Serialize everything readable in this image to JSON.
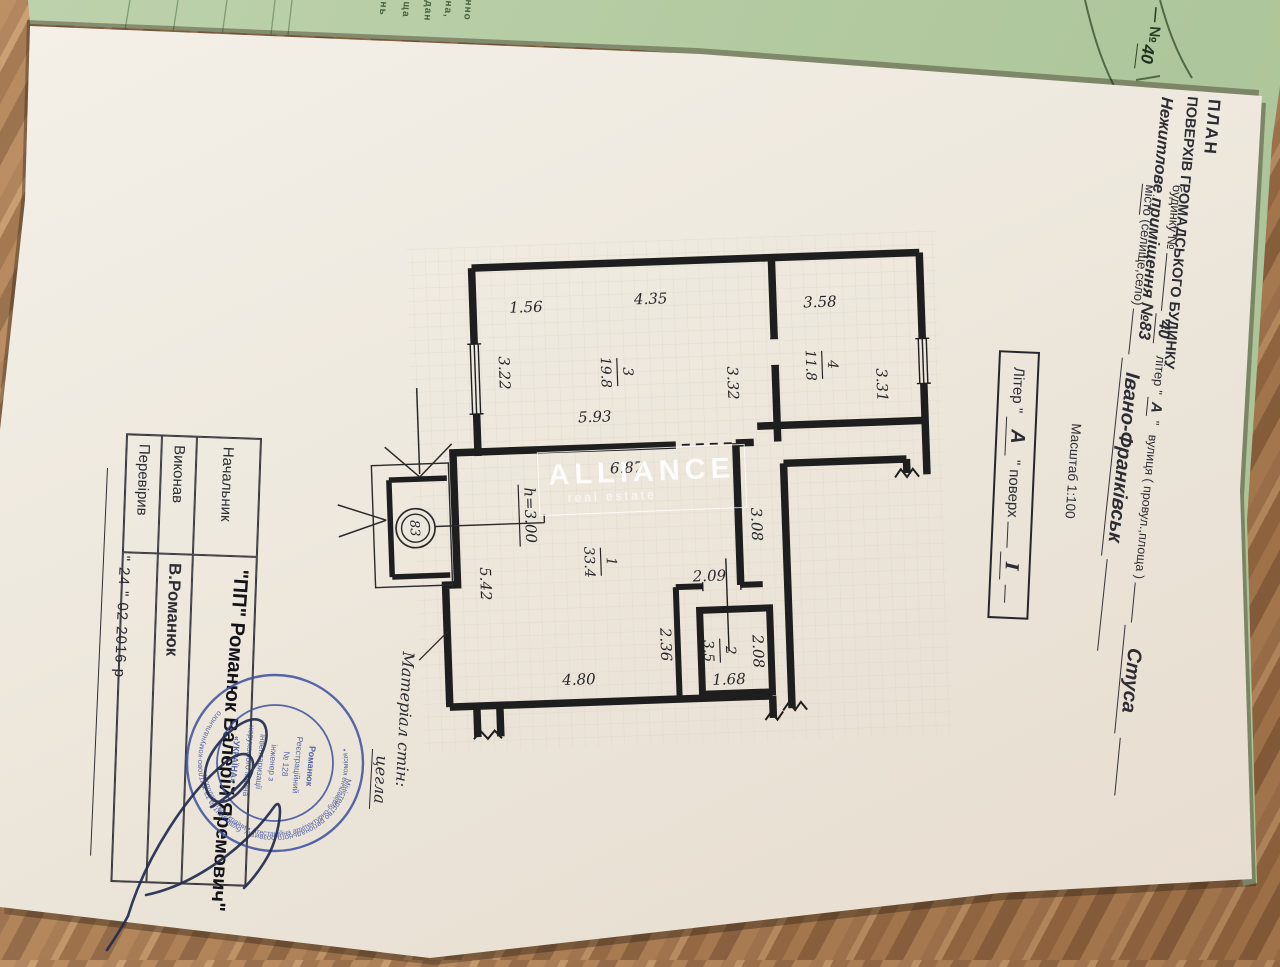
{
  "green_sheet": {
    "number_label": "— №",
    "number_value": "40",
    "fragments": [
      "нно",
      "на,",
      "дан",
      "ща",
      "нь"
    ]
  },
  "header": {
    "title1": "ПЛАН",
    "title2": "ПОВЕРХІВ ГРОМАДСЬКОГО БУДИНКУ",
    "title3": "Нежитлове приміщення №83",
    "house_label": "будинку №",
    "house_number": "40",
    "liter_label": "літер \"",
    "liter_value": "А",
    "liter_close": "\"",
    "street_label": "вулиця ( провул.,площа )",
    "street_value": "Стуса",
    "city_label1": "місто",
    "city_label2": " (селище,село)",
    "city_value": "Івано-Франківськ",
    "scale": "Масштаб 1:100"
  },
  "liter_box": {
    "label": "Літер \"",
    "value": "А",
    "label2": "\"  поверх",
    "floor_value": "I"
  },
  "plan": {
    "dims": {
      "t1": "1.56",
      "t2": "4.35",
      "t3": "3.58",
      "l1": "3.22",
      "m1": "3.32",
      "r1": "3.31",
      "w1": "5.93",
      "w2": "6.87",
      "v1": "3.08",
      "v2": "5.42",
      "b1": "2.09",
      "b2": "2.36",
      "b3": "2.08",
      "b4": "1.68",
      "b5": "4.80",
      "h": "h=3.00"
    },
    "rooms": [
      {
        "num": "1",
        "area": "33.4"
      },
      {
        "num": "2",
        "area": "3.5"
      },
      {
        "num": "3",
        "area": "19.8"
      },
      {
        "num": "4",
        "area": "11.8"
      }
    ],
    "entrance_number": "83"
  },
  "material": {
    "label": "Матеріал стін:",
    "value": "цегла"
  },
  "watermark": {
    "brand": "ALLIANCE",
    "sub": "real estate"
  },
  "table": {
    "rows": [
      {
        "label": "Начальник",
        "value": ""
      },
      {
        "label": "Виконав",
        "value": "В.Романюк"
      },
      {
        "label": "Перевірив",
        "value": ""
      }
    ],
    "date": "\" 24 \"   02   2016 р"
  },
  "stamp": {
    "company": "\"ПП\" Романюк Валерій Яремович\"",
    "ring_top": "Міністерство регіонального розвитку, будівництва та житлово-комунального",
    "ring_bottom": "господарства України • Атестаційна архітектурно-будівельна комісія •",
    "center_lines": [
      "Романюк",
      "Реєстраційний",
      "№ 128",
      "інженер з",
      "інвентаризації",
      "нерухомого майна",
      "«УКРАЇНА»"
    ]
  },
  "colors": {
    "green_sheet": "#b5cba4",
    "wood": "#a97c50",
    "paper": "#efeae0",
    "stamp_blue": "#3c4f9f",
    "ink": "#27272b"
  }
}
